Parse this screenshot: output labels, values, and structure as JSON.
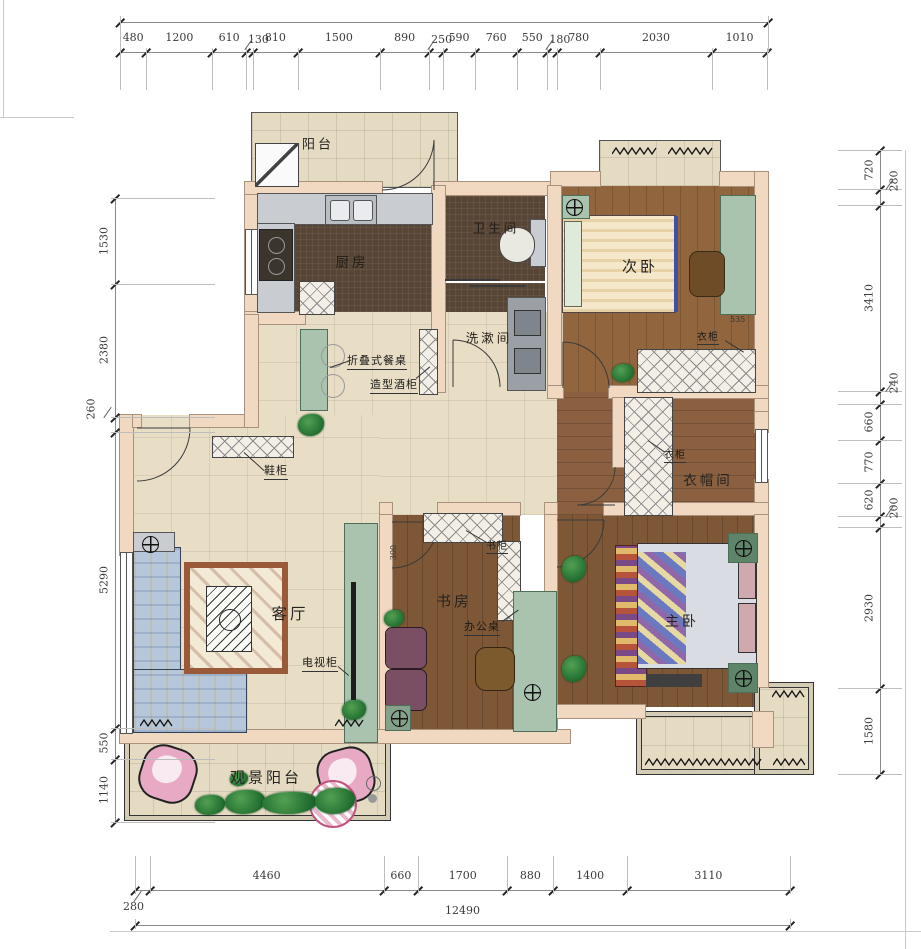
{
  "drawing_type": "residential floor plan",
  "rooms": {
    "balcony_top": "阳台",
    "kitchen": "厨房",
    "bathroom": "卫生间",
    "washroom": "洗漱间",
    "bedroom2": "次卧",
    "cloakroom": "衣帽间",
    "living": "客厅",
    "study": "书房",
    "master": "主卧",
    "view_balcony": "观景阳台"
  },
  "annotations": {
    "folding_table": "折叠式餐桌",
    "wine_cabinet": "造型酒柜",
    "shoe_cabinet": "鞋柜",
    "wardrobe_bedroom2": "衣柜",
    "wardrobe_cloakroom": "衣柜",
    "bookcase": "书柜",
    "desk": "办公桌",
    "tv_cabinet": "电视柜"
  },
  "inline_dims": {
    "wardrobe_depth": "535",
    "bookcase_depth": "300"
  },
  "dimensions": {
    "top": [
      {
        "value": "480"
      },
      {
        "value": "1200"
      },
      {
        "value": "610"
      },
      {
        "value": "130",
        "raised": true
      },
      {
        "value": "810"
      },
      {
        "value": "1500"
      },
      {
        "value": "890"
      },
      {
        "value": "250",
        "raised": true
      },
      {
        "value": "590"
      },
      {
        "value": "760"
      },
      {
        "value": "550"
      },
      {
        "value": "180",
        "raised": true
      },
      {
        "value": "780"
      },
      {
        "value": "2030"
      },
      {
        "value": "1010"
      }
    ],
    "left": [
      {
        "value": "1530"
      },
      {
        "value": "2380"
      },
      {
        "value": "260",
        "raised": true
      },
      {
        "value": "5290"
      },
      {
        "value": "550"
      },
      {
        "value": "1140"
      }
    ],
    "right": [
      {
        "value": "720"
      },
      {
        "value": "280",
        "raised": true
      },
      {
        "value": "3410"
      },
      {
        "value": "240",
        "raised": true
      },
      {
        "value": "660"
      },
      {
        "value": "770"
      },
      {
        "value": "620"
      },
      {
        "value": "200",
        "raised": true
      },
      {
        "value": "2930"
      },
      {
        "value": "1580"
      }
    ],
    "bottom": [
      {
        "value": "280",
        "raised": true
      },
      {
        "value": "4460"
      },
      {
        "value": "660"
      },
      {
        "value": "1700"
      },
      {
        "value": "880"
      },
      {
        "value": "1400"
      },
      {
        "value": "3110"
      }
    ],
    "bottom_total": [
      {
        "value": "12490"
      }
    ]
  },
  "colors": {
    "wall": "#f1d8c1",
    "tile_floor": "#e8dec6",
    "dark_tile": "#574535",
    "wood_floor": "#8d6340",
    "accent_green": "#a9c3af",
    "accent_pink": "#e8a9c4",
    "dim_line": "#8a8a8a"
  }
}
